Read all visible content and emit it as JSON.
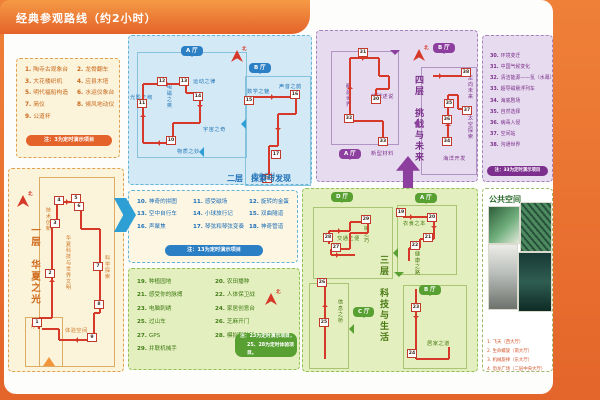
{
  "page": {
    "title": "经典参观路线（约2小时）",
    "north": "北"
  },
  "floor1": {
    "map_title": "一层　华夏之光",
    "exhibits": [
      {
        "n": "1.",
        "name": "陶寺古观象台"
      },
      {
        "n": "2.",
        "name": "龙骨翻车"
      },
      {
        "n": "3.",
        "name": "大花楼织机"
      },
      {
        "n": "4.",
        "name": "应县木塔"
      },
      {
        "n": "5.",
        "name": "明代福船构造"
      },
      {
        "n": "6.",
        "name": "水运仪象台"
      },
      {
        "n": "7.",
        "name": "简仪"
      },
      {
        "n": "8.",
        "name": "候风地动仪"
      },
      {
        "n": "9.",
        "name": "公道杯"
      }
    ],
    "note": "注：3为定时演示项目",
    "zones": [
      "技术创新",
      "华夏科技与世界文明",
      "科学探索",
      "序厅",
      "体验空间"
    ],
    "stops": [
      "1",
      "2",
      "3",
      "4",
      "5",
      "6",
      "7",
      "8",
      "9"
    ]
  },
  "floor2": {
    "map_title": "二层　探索与发现",
    "hall_badges": [
      "A 厅",
      "B 厅"
    ],
    "exhibits": [
      {
        "n": "10.",
        "name": "神奇的拼图"
      },
      {
        "n": "11.",
        "name": "感受磁场"
      },
      {
        "n": "12.",
        "name": "旋转的金蛋"
      },
      {
        "n": "13.",
        "name": "空中自行车"
      },
      {
        "n": "14.",
        "name": "小球旅行记"
      },
      {
        "n": "15.",
        "name": "双曲隧道"
      },
      {
        "n": "16.",
        "name": "声聚焦"
      },
      {
        "n": "17.",
        "name": "琴弦和琴弦变奏"
      },
      {
        "n": "18.",
        "name": "神奇管道"
      }
    ],
    "note": "注：13为定时演示项目",
    "zones": [
      "光影之绚",
      "电磁之奥",
      "运动之律",
      "宇宙之奇",
      "物质之妙",
      "数学之魅",
      "声音之韵",
      "生命之秘"
    ],
    "stops": [
      "10",
      "11",
      "12",
      "13",
      "14",
      "15",
      "16",
      "17",
      "18"
    ]
  },
  "floor3": {
    "map_title": "三层　科技与生活",
    "hall_badges": [
      "D 厅",
      "A 厅",
      "B 厅",
      "C 厅"
    ],
    "exhibits": [
      {
        "n": "19.",
        "name": "种植园地"
      },
      {
        "n": "20.",
        "name": "农田播种"
      },
      {
        "n": "21.",
        "name": "感受你的脉搏"
      },
      {
        "n": "22.",
        "name": "人体保卫战"
      },
      {
        "n": "23.",
        "name": "电脑刺绣"
      },
      {
        "n": "24.",
        "name": "家居创意台"
      },
      {
        "n": "25.",
        "name": "过山车"
      },
      {
        "n": "26.",
        "name": "芝麻开门"
      },
      {
        "n": "27.",
        "name": "GPS"
      },
      {
        "n": "28.",
        "name": "模拟驾驶舱"
      },
      {
        "n": "29.",
        "name": "并联机械手"
      }
    ],
    "note_line1": "注：23为定时演示项目，",
    "note_line2": "25、28为定时体验项目。",
    "zones": [
      "交通之便",
      "机械之巧",
      "衣食之本",
      "健康之路",
      "居家之道",
      "信息之桥"
    ],
    "stops": [
      "19",
      "20",
      "21",
      "22",
      "23",
      "24",
      "25",
      "26",
      "27",
      "28",
      "29"
    ]
  },
  "floor4": {
    "map_title": "四层　挑战与未来",
    "hall_badges": [
      "A 厅",
      "B 厅"
    ],
    "exhibits": [
      {
        "n": "30.",
        "name": "环境变迁"
      },
      {
        "n": "31.",
        "name": "中国气候变化"
      },
      {
        "n": "32.",
        "name": "清洁能源——氢（水幕）"
      },
      {
        "n": "33.",
        "name": "超导磁悬浮列车"
      },
      {
        "n": "34.",
        "name": "海底剧场"
      },
      {
        "n": "35.",
        "name": "自然选择"
      },
      {
        "n": "36.",
        "name": "病毒入侵"
      },
      {
        "n": "37.",
        "name": "空间站"
      },
      {
        "n": "38.",
        "name": "沟通世界"
      }
    ],
    "note": "注：33为定时演示项目",
    "zones": [
      "能源世界",
      "地球述说",
      "新型材料",
      "走向未来",
      "太空探索",
      "海洋开发"
    ],
    "stops": [
      "30",
      "31",
      "32",
      "33",
      "34",
      "35",
      "36",
      "37",
      "38"
    ]
  },
  "public_space": {
    "title": "公共空间",
    "captions": [
      "1. 飞天（西大厅）",
      "2. 生命螺旋（南大厅）",
      "3. 机械旋律（东大厅）",
      "4. 恐龙广场（二层中央大厅）"
    ],
    "photos": [
      "green-ceiling-photo",
      "dna-spiral-photo",
      "dinosaur-skeleton-photo",
      "mural-photo"
    ]
  },
  "colors": {
    "orange": "#e4632a",
    "blue": "#2b7fc4",
    "green": "#58a032",
    "purple": "#8c3f9e",
    "route": "#d6392a"
  }
}
